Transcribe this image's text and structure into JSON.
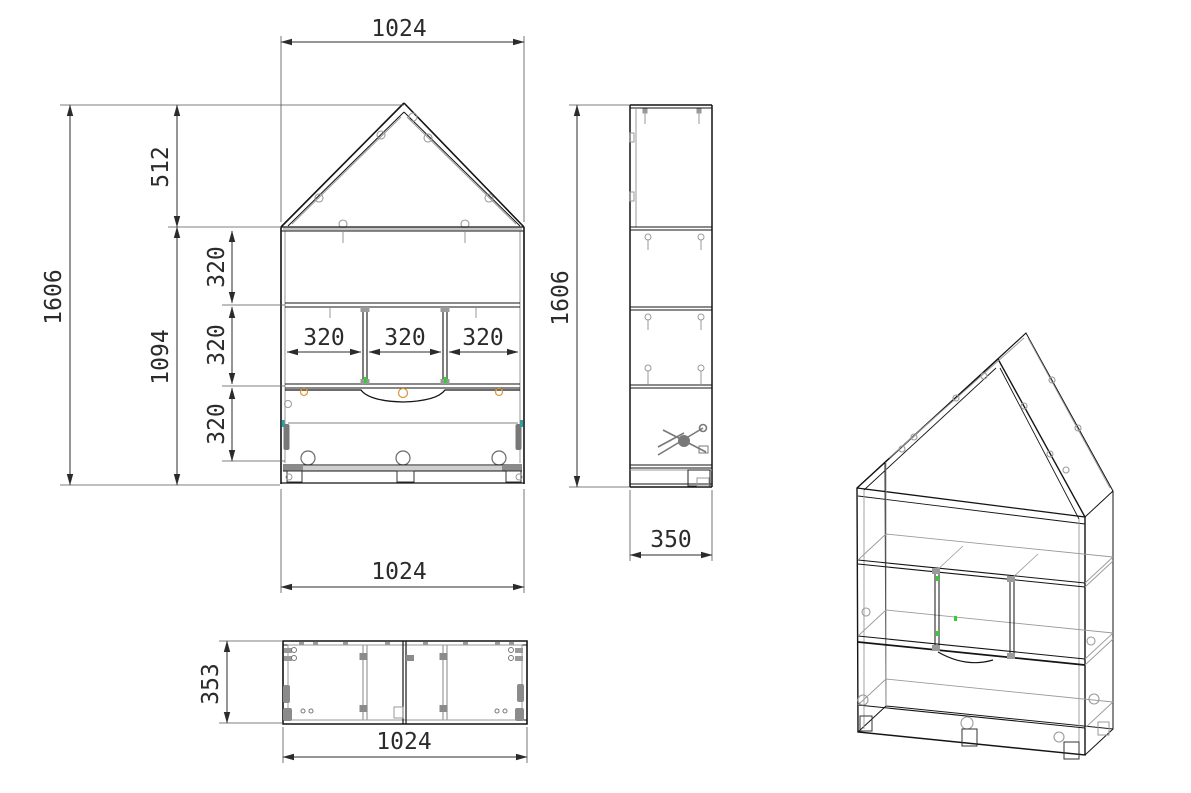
{
  "drawing": {
    "type": "furniture-technical-drawing",
    "subject": "house-shaped shelf cabinet, orthographic views with isometric projection",
    "colors": {
      "line": "#141414",
      "secondary_gray": "#9a9a9a",
      "dimension_text": "#2b2b2b",
      "accent_green": "#35cc35",
      "accent_orange": "#d89b43",
      "accent_teal": "#2f9fa0",
      "background": "#ffffff"
    },
    "front_view": {
      "dim_top_width": "1024",
      "dim_roof_height": "512",
      "dim_total_height": "1606",
      "dim_body_height": "1094",
      "dim_row_heights": [
        "320",
        "320",
        "320"
      ],
      "dim_compartment_widths": [
        "320",
        "320",
        "320"
      ],
      "dim_bottom_width": "1024"
    },
    "side_view": {
      "dim_height": "1606",
      "dim_depth": "350"
    },
    "bottom_view": {
      "dim_depth": "353",
      "dim_width": "1024"
    }
  }
}
